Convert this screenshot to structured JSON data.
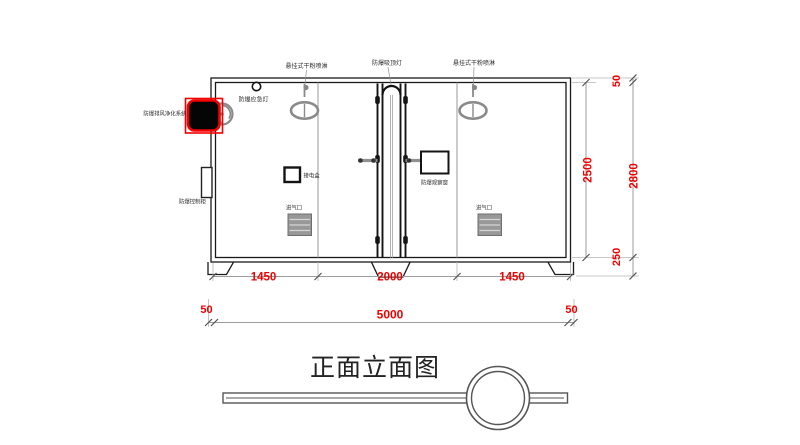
{
  "drawing": {
    "title": "正面立面图",
    "equipment_labels": {
      "sprinkler_left": "悬挂式干粉喷淋",
      "ceiling_light": "防爆吸顶灯",
      "sprinkler_right": "悬挂式干粉喷淋",
      "emergency_light": "防爆应急灯",
      "exhaust_system": "防爆排风净化系统",
      "control_cabinet": "防爆控制柜",
      "junction_box": "接电盒",
      "observation_window": "防爆观察窗",
      "air_inlet_left": "进气口",
      "air_inlet_right": "进气口"
    },
    "dimensions": {
      "bottom_segment_1": "1450",
      "bottom_segment_2": "2000",
      "bottom_segment_3": "1450",
      "bottom_offset_left": "50",
      "bottom_total": "5000",
      "bottom_offset_right": "50",
      "height_inner": "2500",
      "height_offset_top": "50",
      "height_total": "2800",
      "height_offset_bottom": "250"
    }
  },
  "colors": {
    "dimension_text": "#f20000",
    "highlight_box": "#f20000",
    "drawing_line": "#1a1a1a",
    "fixture_gray": "#8a8a8a",
    "background": "#ffffff"
  }
}
